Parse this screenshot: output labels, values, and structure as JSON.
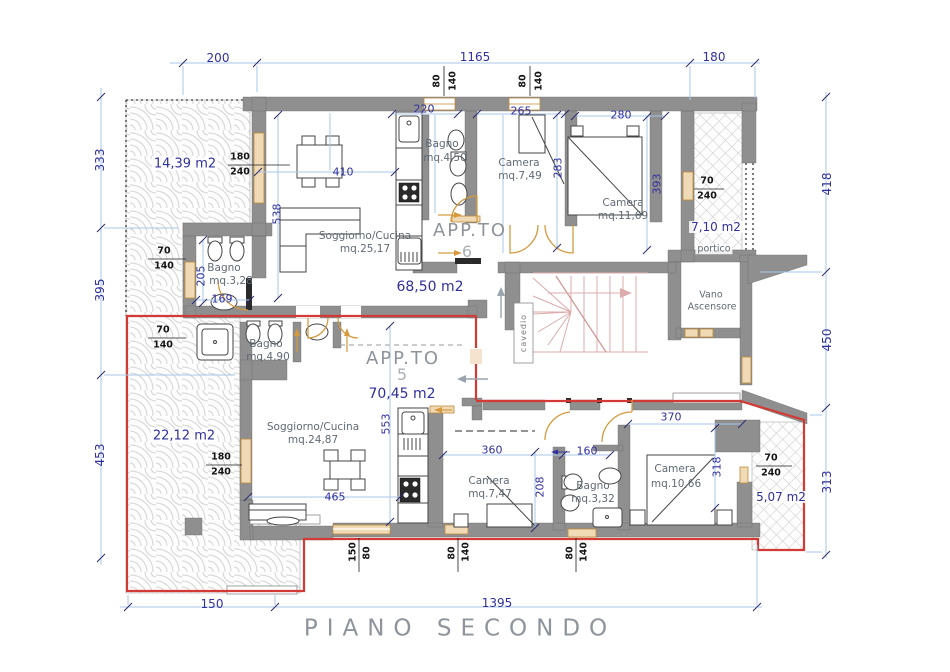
{
  "title": "PIANO SECONDO",
  "colors": {
    "wall": "#8f8f8f",
    "red": "#d23b35",
    "dimblue": "#30309e",
    "dimline": "#a9c7e7",
    "orange": "#d59a3e",
    "tan": "#f0dab6",
    "stair": "#dcacac",
    "room": "#5f6a74",
    "big": "#8d949b"
  },
  "outer_dims": {
    "top": [
      "200",
      "1165",
      "180"
    ],
    "left": [
      "333",
      "395",
      "453"
    ],
    "right": [
      "418",
      "450",
      "313"
    ],
    "bottom": [
      "150",
      "1395"
    ]
  },
  "inner_dims": {
    "d220": "220",
    "d265": "265",
    "d280": "280",
    "d410": "410",
    "d538": "538",
    "d205": "205",
    "d169": "169",
    "d283": "283",
    "d393": "393",
    "d553": "553",
    "d465": "465",
    "d360": "360",
    "d160": "160",
    "d370": "370",
    "d208": "208",
    "d318": "318"
  },
  "window_dims": [
    [
      "80",
      "140"
    ],
    [
      "80",
      "140"
    ],
    [
      "180",
      "240"
    ],
    [
      "70",
      "140"
    ],
    [
      "70",
      "140"
    ],
    [
      "180",
      "240"
    ],
    [
      "70",
      "240"
    ],
    [
      "70",
      "240"
    ],
    [
      "150",
      "80"
    ],
    [
      "80",
      "140"
    ],
    [
      "80",
      "140"
    ]
  ],
  "apt6": {
    "name": "APP.TO",
    "number": "6",
    "area": "68,50 m2",
    "soggiorno": [
      "Soggiorno/Cucina",
      "mq.25,17"
    ],
    "bagno1": [
      "Bagno",
      "mq.3,28"
    ],
    "bagno2": [
      "Bagno",
      "mq.4,50"
    ],
    "camera1": [
      "Camera",
      "mq.7,49"
    ],
    "camera2": [
      "Camera",
      "mq.11,69"
    ]
  },
  "apt5": {
    "name": "APP.TO",
    "number": "5",
    "area": "70,45 m2",
    "soggiorno": [
      "Soggiorno/Cucina",
      "mq.24,87"
    ],
    "bagno1": [
      "Bagno",
      "mq.4,90"
    ],
    "bagno2": [
      "Bagno",
      "mq.3,32"
    ],
    "camera1": [
      "Camera",
      "mq.7,47"
    ],
    "camera2": [
      "Camera",
      "mq.10,66"
    ]
  },
  "terraces": {
    "t_nw": "14,39 m2",
    "t_sw": "22,12 m2",
    "portico": [
      "7,10 m2",
      "portico"
    ],
    "t_se": "5,07 m2"
  },
  "common": {
    "elevator": [
      "Vano",
      "Ascensore"
    ],
    "cavedio": "cavedio"
  }
}
